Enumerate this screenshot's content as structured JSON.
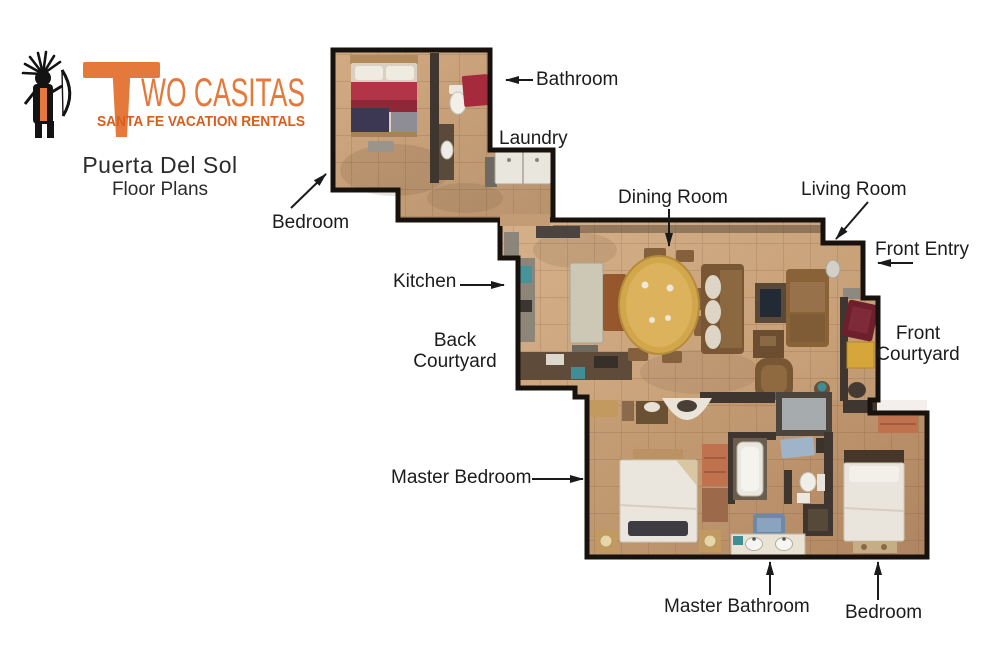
{
  "brand": {
    "name": "Two Casitas",
    "wordmark_initial": "T",
    "wordmark_rest": "WO CASITAS",
    "tagline": "SANTA FE VACATION RENTALS",
    "logo_icon": "petroglyph-archer-figure",
    "brand_color": "#E5793B",
    "tagline_color": "#D85E1D"
  },
  "title": {
    "property_name": "Puerta Del Sol",
    "subtitle": "Floor Plans"
  },
  "floorplan": {
    "style": "top-down 3D dollhouse render",
    "wall_color": "#3e362f",
    "floor_color": "#c9a37c",
    "units": [
      "guest casita (bedroom, bathroom, laundry)",
      "main house (kitchen, dining, living, master suite, second bedroom)"
    ],
    "labels": [
      {
        "id": "bathroom",
        "text": "Bathroom",
        "arrow_direction": "left"
      },
      {
        "id": "laundry",
        "text": "Laundry",
        "arrow_direction": "none"
      },
      {
        "id": "bedroom-upper",
        "text": "Bedroom",
        "arrow_direction": "up-right"
      },
      {
        "id": "kitchen",
        "text": "Kitchen",
        "arrow_direction": "right"
      },
      {
        "id": "back-courtyard",
        "text": "Back\nCourtyard",
        "arrow_direction": "none"
      },
      {
        "id": "dining-room",
        "text": "Dining Room",
        "arrow_direction": "down"
      },
      {
        "id": "living-room",
        "text": "Living Room",
        "arrow_direction": "down-left"
      },
      {
        "id": "front-entry",
        "text": "Front Entry",
        "arrow_direction": "left"
      },
      {
        "id": "front-courtyard",
        "text": "Front\nCourtyard",
        "arrow_direction": "none"
      },
      {
        "id": "master-bedroom",
        "text": "Master Bedroom",
        "arrow_direction": "right"
      },
      {
        "id": "master-bathroom",
        "text": "Master Bathroom",
        "arrow_direction": "up"
      },
      {
        "id": "bedroom-lower",
        "text": "Bedroom",
        "arrow_direction": "up"
      }
    ]
  }
}
